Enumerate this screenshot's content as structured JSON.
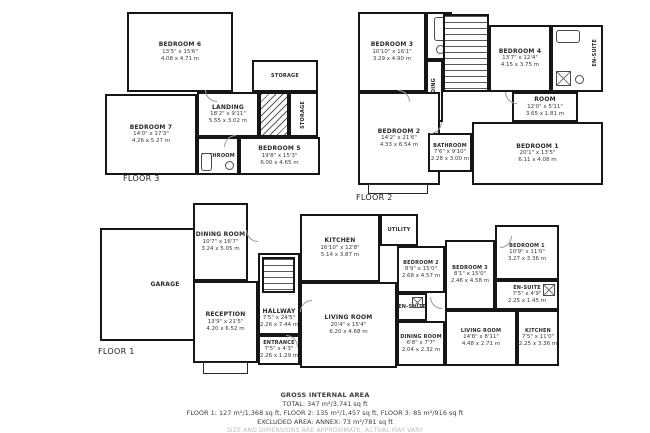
{
  "floors": {
    "floor3": {
      "label": "FLOOR 3",
      "rooms": {
        "bedroom6": {
          "name": "BEDROOM 6",
          "ft": "13'5\" x 15'6\"",
          "m": "4.08 x 4.71 m"
        },
        "bedroom7": {
          "name": "BEDROOM 7",
          "ft": "14'0\" x 17'3\"",
          "m": "4.26 x 5.27 m"
        },
        "landing": {
          "name": "LANDING",
          "ft": "18'2\" x 9'11\"",
          "m": "5.55 x 3.02 m"
        },
        "bedroom5": {
          "name": "BEDROOM 5",
          "ft": "19'8\" x 15'3\"",
          "m": "6.00 x 4.65 m"
        },
        "bathroom": {
          "name": "BATHROOM"
        },
        "storage1": {
          "name": "STORAGE"
        },
        "storage2": {
          "name": "STORAGE"
        }
      }
    },
    "floor2": {
      "label": "FLOOR 2",
      "rooms": {
        "bedroom3": {
          "name": "BEDROOM 3",
          "ft": "10'10\" x 16'1\"",
          "m": "3.29 x 4.90 m"
        },
        "bedroom4": {
          "name": "BEDROOM 4",
          "ft": "13'7\" x 12'4\"",
          "m": "4.15 x 3.75 m"
        },
        "landing": {
          "name": "LANDING"
        },
        "ensuite": {
          "name": "EN-SUITE"
        },
        "room": {
          "name": "ROOM",
          "ft": "12'0\" x 5'11\"",
          "m": "3.65 x 1.81 m"
        },
        "bedroom2": {
          "name": "BEDROOM 2",
          "ft": "14'2\" x 21'6\"",
          "m": "4.33 x 6.54 m"
        },
        "bathroom": {
          "name": "BATHROOM",
          "ft": "7'6\" x 9'10\"",
          "m": "2.28 x 3.00 m"
        },
        "bedroom1": {
          "name": "BEDROOM 1",
          "ft": "20'1\" x 13'5\"",
          "m": "6.11 x 4.08 m"
        }
      }
    },
    "floor1": {
      "label": "FLOOR 1",
      "rooms": {
        "garage": {
          "name": "GARAGE"
        },
        "dining": {
          "name": "DINING ROOM",
          "ft": "10'7\" x 16'7\"",
          "m": "3.24 x 5.05 m"
        },
        "kitchen": {
          "name": "KITCHEN",
          "ft": "16'10\" x 12'8\"",
          "m": "5.14 x 3.87 m"
        },
        "utility": {
          "name": "UTILITY"
        },
        "hallway": {
          "name": "HALLWAY",
          "ft": "7'5\" x 24'5\"",
          "m": "2.26 x 7.44 m"
        },
        "reception": {
          "name": "RECEPTION",
          "ft": "13'9\" x 21'5\"",
          "m": "4.20 x 6.52 m"
        },
        "entrance": {
          "name": "ENTRANCE",
          "ft": "7'5\" x 4'3\"",
          "m": "2.26 x 1.29 m"
        },
        "living": {
          "name": "LIVING ROOM",
          "ft": "20'4\" x 15'4\"",
          "m": "6.20 x 4.68 m"
        }
      }
    },
    "annex": {
      "rooms": {
        "bedroom2": {
          "name": "BEDROOM 2",
          "ft": "8'9\" x 15'0\"",
          "m": "2.68 x 4.57 m"
        },
        "bedroom3": {
          "name": "BEDROOM 3",
          "ft": "8'1\" x 15'0\"",
          "m": "2.46 x 4.58 m"
        },
        "bedroom1": {
          "name": "BEDROOM 1",
          "ft": "10'9\" x 11'0\"",
          "m": "3.27 x 3.36 m"
        },
        "ensuiteRight": {
          "name": "EN-SUITE",
          "ft": "7'5\" x 4'9\"",
          "m": "2.25 x 1.45 m"
        },
        "ensuiteLeft": {
          "name": "EN-SUITE"
        },
        "dining": {
          "name": "DINING ROOM",
          "ft": "6'8\" x 7'7\"",
          "m": "2.04 x 2.32 m"
        },
        "living": {
          "name": "LIVING ROOM",
          "ft": "14'8\" x 8'11\"",
          "m": "4.48 x 2.71 m"
        },
        "kitchen": {
          "name": "KITCHEN",
          "ft": "7'5\" x 11'0\"",
          "m": "2.25 x 3.36 m"
        }
      }
    }
  },
  "footer": {
    "title": "GROSS INTERNAL AREA",
    "total": "TOTAL: 347 m²/3,741 sq ft",
    "perFloor": "FLOOR 1: 127 m²/1,368 sq ft, FLOOR 2: 135 m²/1,457 sq ft, FLOOR 3: 85 m²/916 sq ft",
    "excluded": "EXCLUDED AREA: ANNEX: 73 m²/781 sq ft",
    "note": "SIZE AND DIMENSIONS ARE APPROXIMATE, ACTUAL MAY VARY"
  }
}
